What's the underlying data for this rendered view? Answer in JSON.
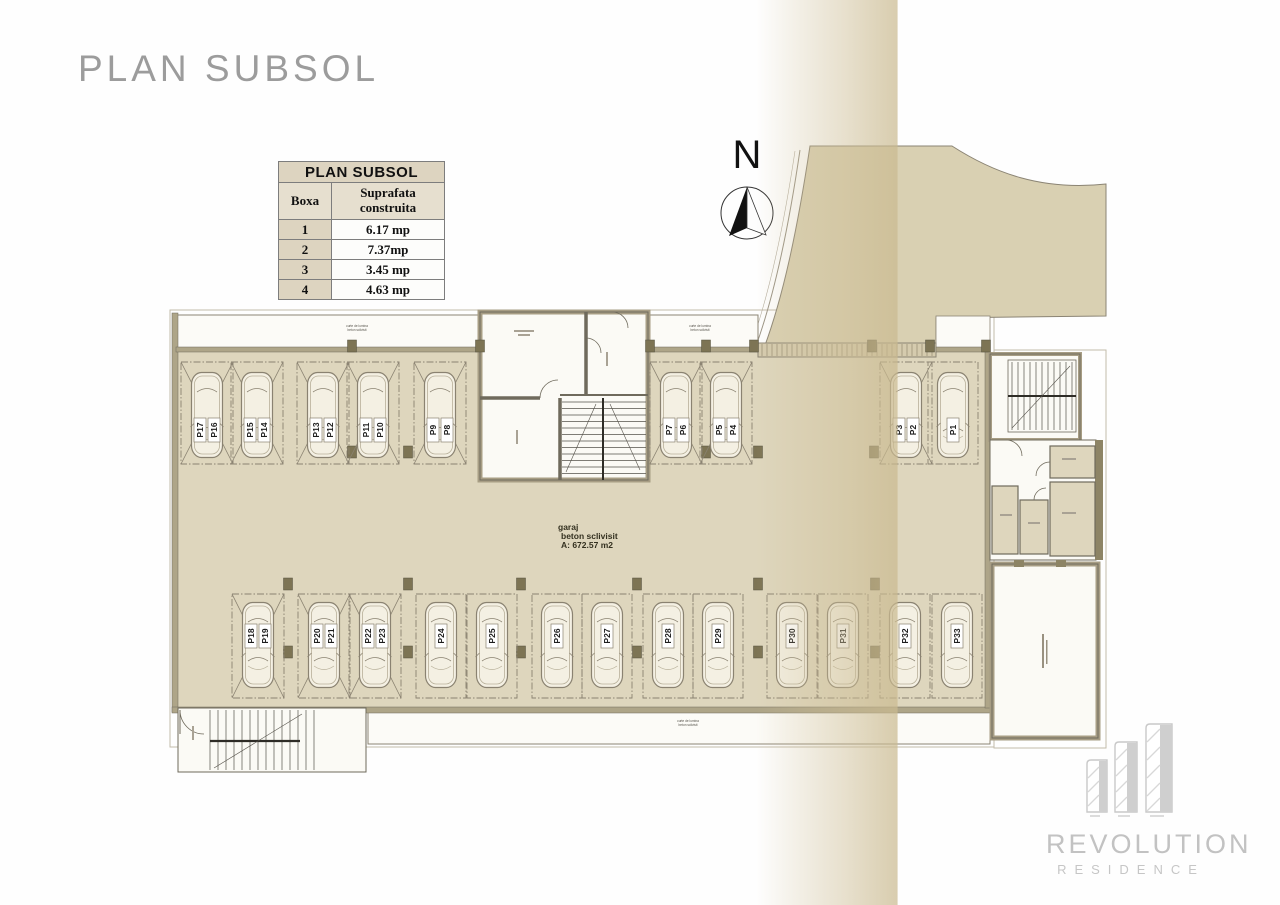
{
  "page": {
    "title": "PLAN SUBSOL"
  },
  "legend_table": {
    "title": "PLAN SUBSOL",
    "columns": [
      "Boxa",
      "Suprafata construita"
    ],
    "rows": [
      [
        "1",
        "6.17 mp"
      ],
      [
        "2",
        "7.37mp"
      ],
      [
        "3",
        "3.45 mp"
      ],
      [
        "4",
        "4.63 mp"
      ]
    ]
  },
  "compass": {
    "label": "N"
  },
  "plan": {
    "garage_label": [
      "garaj",
      "beton  sclivisit",
      "A: 672.57 m2"
    ],
    "annotations": [
      {
        "x": 357,
        "y": 327,
        "lines": [
          "curte de lumina",
          "beton sclivisit"
        ]
      },
      {
        "x": 700,
        "y": 327,
        "lines": [
          "curte de lumina",
          "beton sclivisit"
        ]
      },
      {
        "x": 688,
        "y": 722,
        "lines": [
          "curte de lumina",
          "beton sclivisit"
        ]
      }
    ],
    "colors": {
      "floor": "#ded6bd",
      "driveway": "#d9d0b2",
      "wall_fill": "#aea588",
      "wall_line": "#6f6a5c",
      "column": "#7d7454",
      "car_fill": "#f4f0e3",
      "bay_line": "#8a8271",
      "band": "#cebe96"
    },
    "top_spots": [
      {
        "labels": [
          "P17",
          "P16"
        ],
        "cx": 207,
        "crossed": true
      },
      {
        "labels": [
          "P15",
          "P14"
        ],
        "cx": 257,
        "crossed": true
      },
      {
        "labels": [
          "P13",
          "P12"
        ],
        "cx": 323,
        "crossed": true
      },
      {
        "labels": [
          "P11",
          "P10"
        ],
        "cx": 373,
        "crossed": true
      },
      {
        "labels": [
          "P9",
          "P8"
        ],
        "cx": 440,
        "crossed": true
      },
      {
        "labels": [
          "P7",
          "P6"
        ],
        "cx": 676,
        "crossed": true
      },
      {
        "labels": [
          "P5",
          "P4"
        ],
        "cx": 726,
        "crossed": true
      },
      {
        "labels": [
          "P3",
          "P2"
        ],
        "cx": 906,
        "crossed": true
      },
      {
        "labels": [
          "P1"
        ],
        "cx": 953,
        "crossed": false
      }
    ],
    "bottom_spots": [
      {
        "labels": [
          "P18",
          "P19"
        ],
        "cx": 258,
        "crossed": true
      },
      {
        "labels": [
          "P20",
          "P21"
        ],
        "cx": 324,
        "crossed": true
      },
      {
        "labels": [
          "P22",
          "P23"
        ],
        "cx": 375,
        "crossed": true
      },
      {
        "labels": [
          "P24"
        ],
        "cx": 441,
        "crossed": false
      },
      {
        "labels": [
          "P25"
        ],
        "cx": 492,
        "crossed": false
      },
      {
        "labels": [
          "P26"
        ],
        "cx": 557,
        "crossed": false
      },
      {
        "labels": [
          "P27"
        ],
        "cx": 607,
        "crossed": false
      },
      {
        "labels": [
          "P28"
        ],
        "cx": 668,
        "crossed": false
      },
      {
        "labels": [
          "P29"
        ],
        "cx": 718,
        "crossed": false
      },
      {
        "labels": [
          "P30"
        ],
        "cx": 792,
        "crossed": false
      },
      {
        "labels": [
          "P31"
        ],
        "cx": 843,
        "crossed": false
      },
      {
        "labels": [
          "P32"
        ],
        "cx": 905,
        "crossed": false
      },
      {
        "labels": [
          "P33"
        ],
        "cx": 957,
        "crossed": false
      }
    ]
  },
  "logo": {
    "line1": "REVOLUTION",
    "line2": "RESIDENCE"
  }
}
